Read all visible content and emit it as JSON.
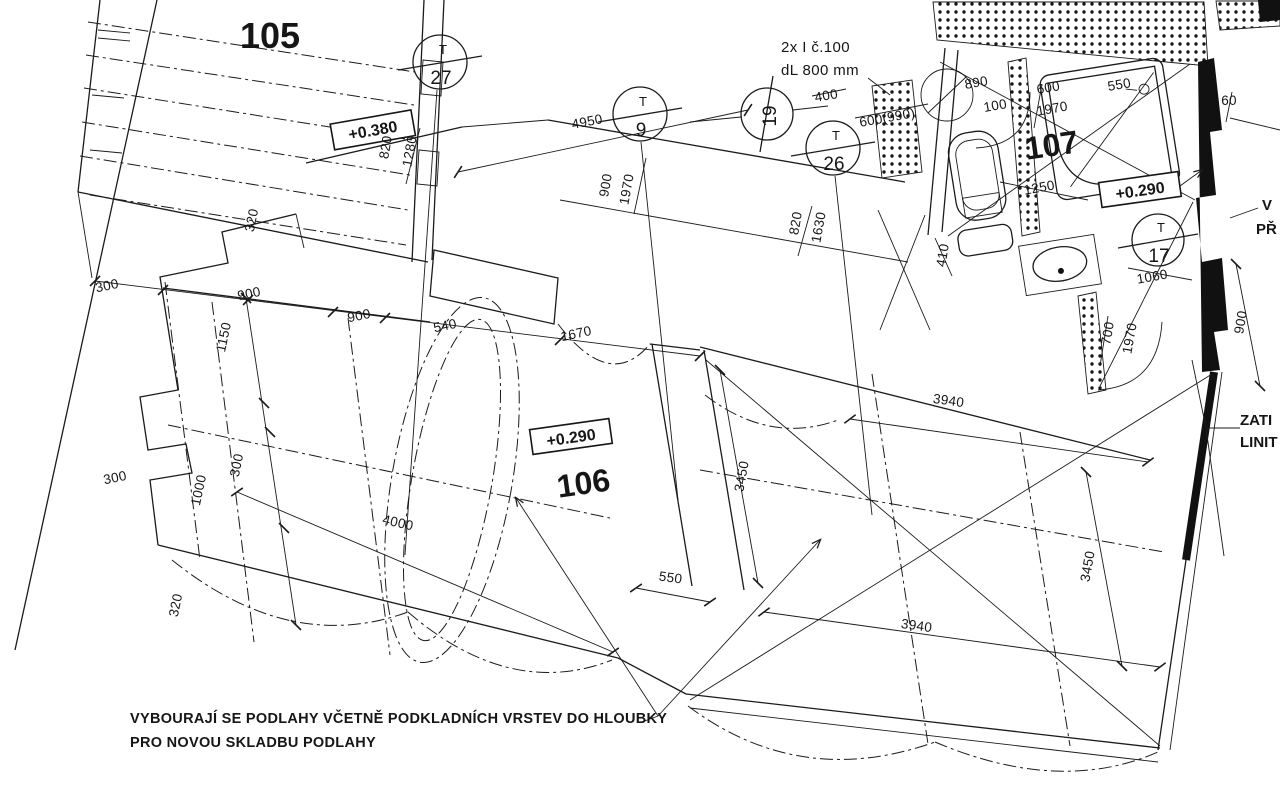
{
  "rooms": {
    "r105": "105",
    "r106": "106",
    "r107": "107"
  },
  "elevations": {
    "e380": "+0.380",
    "e290_106": "+0.290",
    "e290_107": "+0.290"
  },
  "axis_markers": {
    "m27t": "T",
    "m27": "27",
    "m9t": "T",
    "m9": "9",
    "m19": "19",
    "m26t": "T",
    "m26": "26",
    "m17t": "T",
    "m17": "17"
  },
  "notes": {
    "beam1": "2x I č.100",
    "beam2": "dL 800 mm",
    "demo1": "VYBOURAJÍ SE PODLAHY VČETNĚ PODKLADNÍCH VRSTEV DO HLOUBKY",
    "demo2": "PRO NOVOU SKLADBU PODLAHY",
    "edge_top1": "V",
    "edge_top2": "PŘ",
    "edge_bot1": "ZATI",
    "edge_bot2": "LINIT"
  },
  "dims": {
    "d4950": "4950",
    "d820a": "820",
    "d1280": "1280",
    "d900a": "900",
    "d1970a": "1970",
    "d400": "400",
    "d600b": "600(990)",
    "d820b": "820",
    "d1630": "1630",
    "d890": "890",
    "d100": "100",
    "d600": "600",
    "d1970b": "1970",
    "d550a": "550",
    "d60": "60",
    "d1250": "1250",
    "d410": "410",
    "d1060": "1060",
    "d700": "700",
    "d1970c": "1970",
    "d900r": "900",
    "d320a": "320",
    "d300a": "300",
    "d900b": "900",
    "d900c": "900",
    "d540": "540",
    "d1670": "1670",
    "d1150": "1150",
    "d300b": "300",
    "d1000": "1000",
    "d300c": "300",
    "d320b": "320",
    "d4000": "4000",
    "d550b": "550",
    "d3450a": "3450",
    "d3940a": "3940",
    "d3940b": "3940",
    "d3450b": "3450"
  },
  "colors": {
    "line": "#1b1b1b",
    "background": "#ffffff"
  }
}
